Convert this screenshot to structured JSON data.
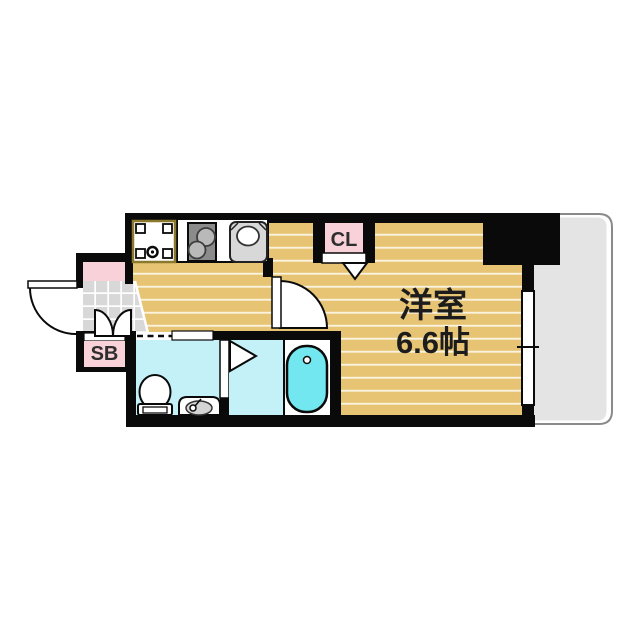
{
  "plan": {
    "main_room": {
      "label": "洋室",
      "size": "6.6帖"
    },
    "closet": {
      "label": "CL"
    },
    "shoe_box": {
      "label": "SB"
    }
  },
  "palette": {
    "wall": "#0a0a0a",
    "wood": "#e7c473",
    "stripe": "#faf3dd",
    "pink": "#f8d2d8",
    "tile": "#d8d8d8",
    "tilegrid": "#ffffff",
    "wet": "#c4f1f7",
    "tub": "#72e7ef",
    "balcony": "#e4e4e4",
    "balconyline": "#8a8a8a",
    "appliance": "#8b8b8b",
    "burner": "#b9b9b9",
    "sinkgray": "#d8d8d8",
    "panborder": "#8b7a2e",
    "ink": "#1c1c1c"
  }
}
